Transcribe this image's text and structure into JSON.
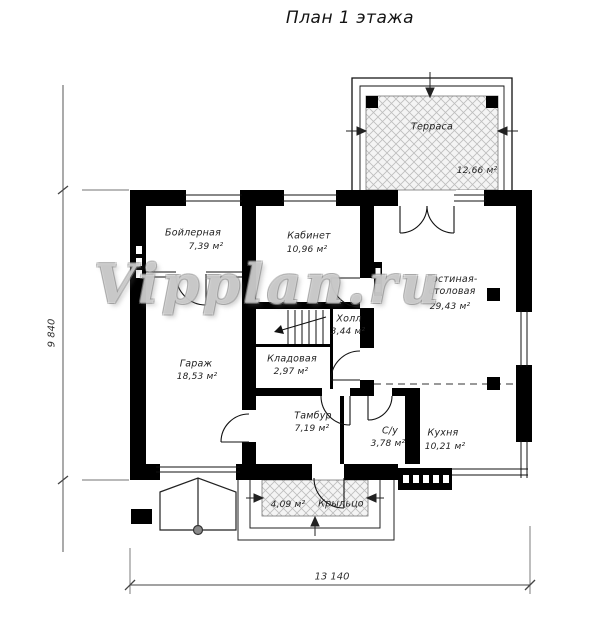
{
  "title": "План 1 этажа",
  "watermark": "Vipplan.ru",
  "rooms": [
    {
      "name": "Терраса",
      "area": "12,66 м²"
    },
    {
      "name": "Бойлерная",
      "area": "7,39 м²"
    },
    {
      "name": "Кабинет",
      "area": "10,96 м²"
    },
    {
      "name": "Гостиная-столовая",
      "area": "29,43 м²"
    },
    {
      "name": "Гараж",
      "area": "18,53 м²"
    },
    {
      "name": "Холл",
      "area": "3,44 м²"
    },
    {
      "name": "Кладовая",
      "area": "2,97 м²"
    },
    {
      "name": "Тамбур",
      "area": "7,19 м²"
    },
    {
      "name": "С/у",
      "area": "3,78 м²"
    },
    {
      "name": "Кухня",
      "area": "10,21 м²"
    },
    {
      "name": "Крыльцо",
      "area": "4,09 м²"
    }
  ],
  "dimensions": {
    "height_total": "9 840",
    "width_total": "13 140"
  },
  "colors": {
    "walls": "#000000",
    "thin_lines": "#1a1a1a",
    "hatch": "#bdbdbd",
    "watermark_gray": "#8c8c8c",
    "background": "#ffffff"
  }
}
